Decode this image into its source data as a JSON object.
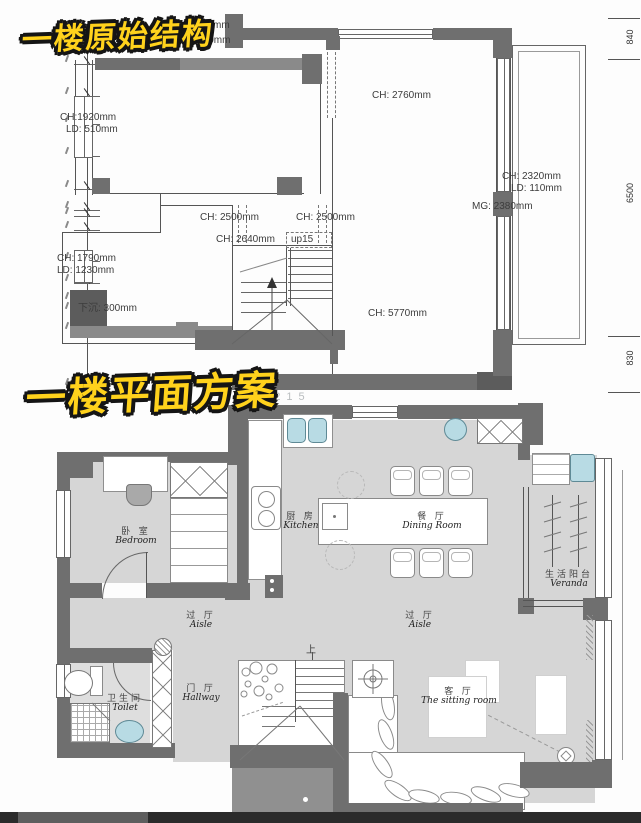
{
  "titles": {
    "original": "一楼原始结构",
    "plan": "一楼平面方案"
  },
  "original_plan": {
    "annotations": {
      "ld1020_partial": "mm",
      "ld1020": "LD:1020mm",
      "ch2760": "CH: 2760mm",
      "ch1920": "CH:1920mm",
      "ld510": "LD: 510mm",
      "ch2320": "CH: 2320mm",
      "ld110": "LD: 110mm",
      "mg2380": "MG: 2380mm",
      "ch2500_left": "CH: 2500mm",
      "ch2500_right": "CH: 2500mm",
      "ch2640": "CH: 2640mm",
      "up15": "up15",
      "ch1790": "CH: 1790mm",
      "ld1230": "LD: 1230mm",
      "sunken": "下沉: 300mm",
      "ch5770": "CH: 5770mm"
    },
    "dims": {
      "d840": "840",
      "d6500": "6500",
      "d830": "830"
    }
  },
  "floor_plan": {
    "watermark": "00215",
    "up_label": "上",
    "rooms": {
      "bedroom": {
        "zh": "卧 室",
        "en": "Bedroom"
      },
      "kitchen": {
        "zh": "厨 房",
        "en": "Kitchen"
      },
      "dining": {
        "zh": "餐 厅",
        "en": "Dining Room"
      },
      "veranda": {
        "zh": "生活阳台",
        "en": "Veranda"
      },
      "aisle_left": {
        "zh": "过 厅",
        "en": "Aisle"
      },
      "aisle_right": {
        "zh": "过 厅",
        "en": "Aisle"
      },
      "hallway": {
        "zh": "门 厅",
        "en": "Hallway"
      },
      "toilet": {
        "zh": "卫生间",
        "en": "Toilet"
      },
      "sitting": {
        "zh": "客 厅",
        "en": "The sitting room"
      }
    },
    "colors": {
      "wall": "#6f6f6f",
      "floor": "#d6d6d6",
      "accent_blue": "#b8dbe4",
      "title_yellow": "#ffd21c"
    }
  }
}
